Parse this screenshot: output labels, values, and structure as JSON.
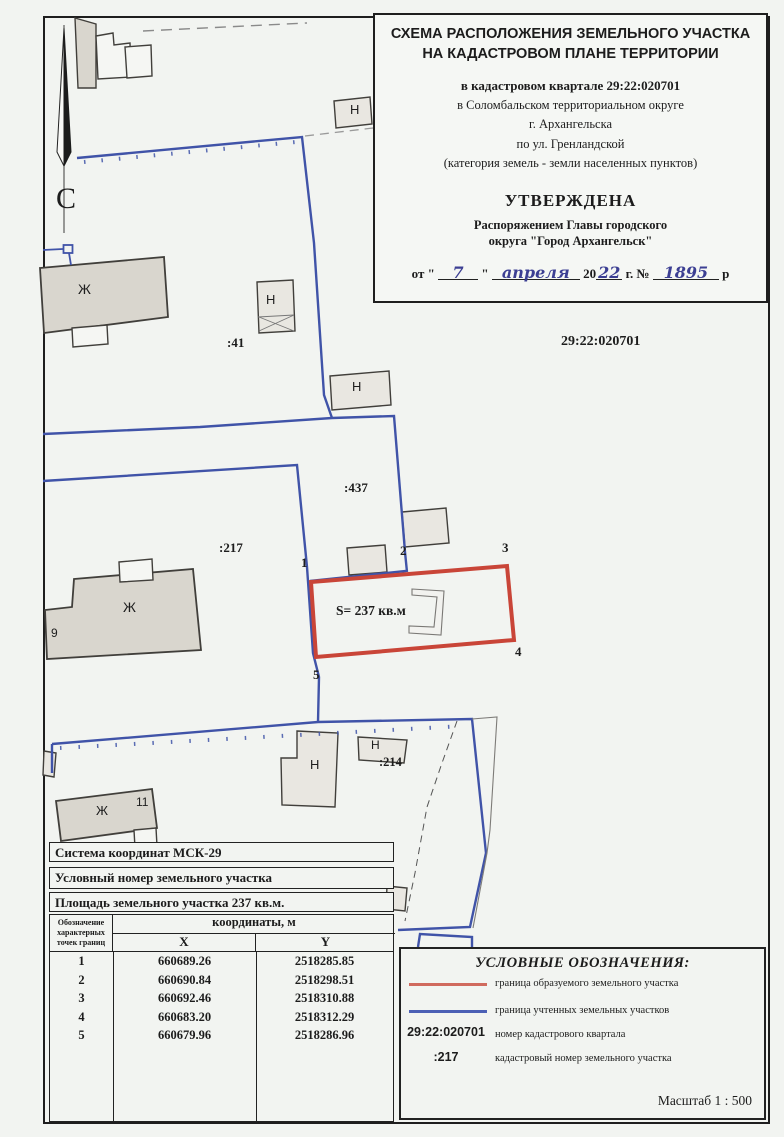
{
  "colors": {
    "boundary_new_red": "#c94538",
    "boundary_existing_blue": "#4053a8",
    "handwriting_ink": "#3c3f93",
    "building_fill": "#d9d6ce",
    "paper": "#f2f4f1"
  },
  "title_block": {
    "title_line1": "СХЕМА РАСПОЛОЖЕНИЯ ЗЕМЕЛЬНОГО УЧАСТКА",
    "title_line2": "НА КАДАСТРОВОМ ПЛАНЕ ТЕРРИТОРИИ",
    "quarter_line": "в кадастровом квартале 29:22:020701",
    "loc_line1": "в Соломбальском территориальном округе",
    "loc_line2": "г. Архангельска",
    "loc_line3": "по ул. Гренландской",
    "loc_line4": "(категория земель - земли населенных пунктов)",
    "approved": "УТВЕРЖДЕНА",
    "approved_by1": "Распоряжением Главы городского",
    "approved_by2": "округа \"Город Архангельск\"",
    "date": {
      "prefix": "от \"",
      "day": "7",
      "quote2": "\"",
      "month": "апреля",
      "year_printed": "20",
      "year_hand": "22",
      "mid": "г. №",
      "number": "1895",
      "suffix": "р"
    }
  },
  "map": {
    "labels": [
      {
        "name": "north-letter",
        "text": "С",
        "x": 56,
        "y": 184,
        "fs": 30,
        "f": "serif",
        "w": 400
      },
      {
        "name": "building-zh-top",
        "text": "Ж",
        "x": 78,
        "y": 282,
        "fs": 14,
        "f": "sans",
        "w": 400
      },
      {
        "name": "building-n-top",
        "text": "Н",
        "x": 350,
        "y": 103,
        "fs": 13,
        "f": "sans",
        "w": 400
      },
      {
        "name": "parcel-41",
        "text": ":41",
        "x": 227,
        "y": 336,
        "fs": 13,
        "f": "serif",
        "w": 700
      },
      {
        "name": "building-n-mid",
        "text": "Н",
        "x": 266,
        "y": 293,
        "fs": 13,
        "f": "sans",
        "w": 400
      },
      {
        "name": "building-n-right",
        "text": "Н",
        "x": 352,
        "y": 380,
        "fs": 13,
        "f": "sans",
        "w": 400
      },
      {
        "name": "quarter-number",
        "text": "29:22:020701",
        "x": 561,
        "y": 335,
        "fs": 14,
        "f": "serif",
        "w": 700
      },
      {
        "name": "parcel-437",
        "text": ":437",
        "x": 344,
        "y": 481,
        "fs": 13,
        "f": "serif",
        "w": 700
      },
      {
        "name": "parcel-217",
        "text": ":217",
        "x": 219,
        "y": 541,
        "fs": 13,
        "f": "serif",
        "w": 700
      },
      {
        "name": "building-zh-217",
        "text": "Ж",
        "x": 123,
        "y": 600,
        "fs": 14,
        "f": "sans",
        "w": 400
      },
      {
        "name": "house-number-9",
        "text": "9",
        "x": 51,
        "y": 627,
        "fs": 12,
        "f": "sans",
        "w": 400
      },
      {
        "name": "point-1",
        "text": "1",
        "x": 301,
        "y": 556,
        "fs": 13,
        "f": "serif",
        "w": 700
      },
      {
        "name": "point-2",
        "text": "2",
        "x": 400,
        "y": 544,
        "fs": 13,
        "f": "serif",
        "w": 700
      },
      {
        "name": "point-3",
        "text": "3",
        "x": 502,
        "y": 541,
        "fs": 13,
        "f": "serif",
        "w": 700
      },
      {
        "name": "point-4",
        "text": "4",
        "x": 515,
        "y": 645,
        "fs": 13,
        "f": "serif",
        "w": 700
      },
      {
        "name": "point-5",
        "text": "5",
        "x": 313,
        "y": 668,
        "fs": 13,
        "f": "serif",
        "w": 700
      },
      {
        "name": "plot-area",
        "text": "S= 237 кв.м",
        "x": 336,
        "y": 604,
        "fs": 13.5,
        "f": "serif",
        "w": 700
      },
      {
        "name": "building-zh-11",
        "text": "Ж",
        "x": 96,
        "y": 804,
        "fs": 13,
        "f": "sans",
        "w": 400
      },
      {
        "name": "house-number-11",
        "text": "11",
        "x": 136,
        "y": 796,
        "fs": 12,
        "f": "sans",
        "w": 400
      },
      {
        "name": "building-n-big",
        "text": "Н",
        "x": 310,
        "y": 758,
        "fs": 13,
        "f": "sans",
        "w": 400
      },
      {
        "name": "building-n-214",
        "text": "Н",
        "x": 371,
        "y": 739,
        "fs": 12,
        "f": "sans",
        "w": 400
      },
      {
        "name": "parcel-214",
        "text": ":214",
        "x": 379,
        "y": 756,
        "fs": 12.5,
        "f": "serif",
        "w": 700
      }
    ]
  },
  "table": {
    "row1": "Система координат МСК-29",
    "row2": "Условный номер земельного участка",
    "row3": "Площадь земельного участка 237 кв.м.",
    "col1_lines": [
      "Обозначение",
      "характерных",
      "точек границ"
    ],
    "coords_header": "координаты, м",
    "x_header": "X",
    "y_header": "Y",
    "points": [
      {
        "n": "1",
        "x": "660689.26",
        "y": "2518285.85"
      },
      {
        "n": "2",
        "x": "660690.84",
        "y": "2518298.51"
      },
      {
        "n": "3",
        "x": "660692.46",
        "y": "2518310.88"
      },
      {
        "n": "4",
        "x": "660683.20",
        "y": "2518312.29"
      },
      {
        "n": "5",
        "x": "660679.96",
        "y": "2518286.96"
      }
    ]
  },
  "legend": {
    "title": "УСЛОВНЫЕ ОБОЗНАЧЕНИЯ:",
    "item1_label": "граница образуемого земельного участка",
    "item2_label": "граница учтенных земельных участков",
    "item3_code": "29:22:020701",
    "item3_label": "номер кадастрового квартала",
    "item4_code": ":217",
    "item4_label": "кадастровый номер земельного участка",
    "scale": "Масштаб  1 : 500"
  }
}
